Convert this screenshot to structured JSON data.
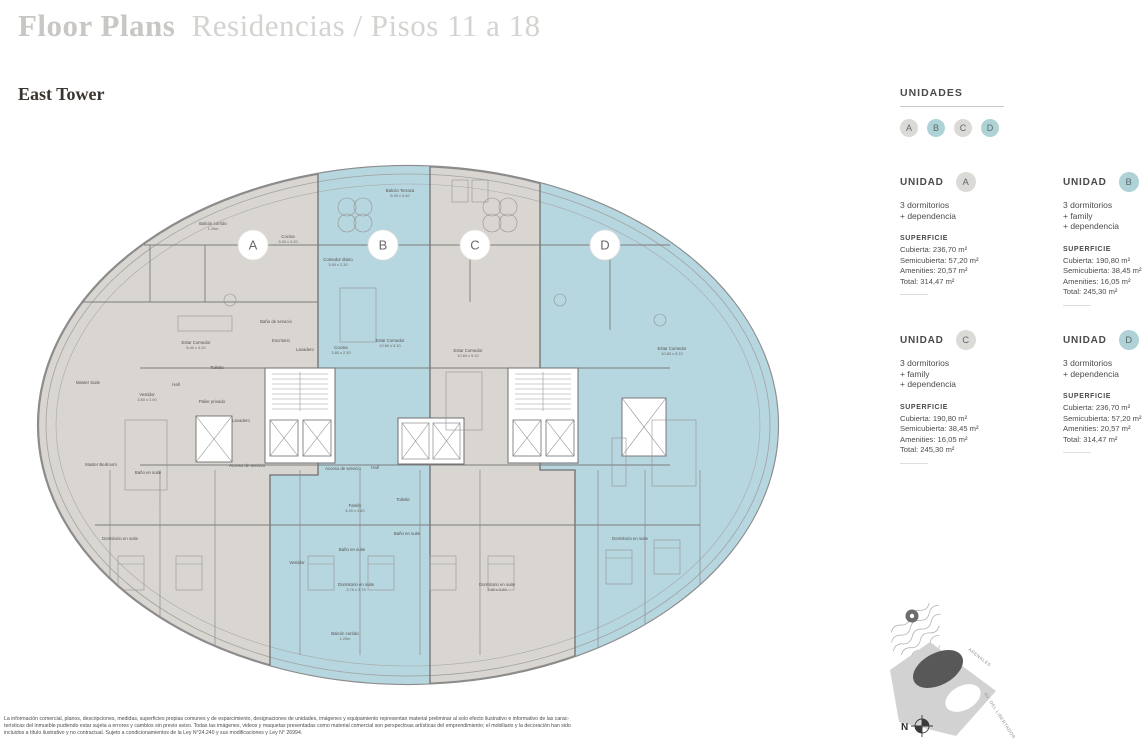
{
  "header": {
    "title_bold": "Floor Plans",
    "title_light": "Residencias / Pisos 11 a 18",
    "subtitle": "East Tower"
  },
  "legend": {
    "title": "UNIDADES",
    "badges": [
      {
        "letter": "A",
        "teal": false
      },
      {
        "letter": "B",
        "teal": true
      },
      {
        "letter": "C",
        "teal": false
      },
      {
        "letter": "D",
        "teal": true
      }
    ]
  },
  "units": [
    {
      "name": "UNIDAD",
      "letter": "A",
      "teal": false,
      "desc": [
        "3 dormitorios",
        "+ dependencia"
      ],
      "sup_title": "SUPERFICIE",
      "sup": [
        "Cubierta: 236,70 m²",
        "Semicubierta: 57,20 m²",
        "Amenities: 20,57 m²",
        "Total: 314,47 m²"
      ]
    },
    {
      "name": "UNIDAD",
      "letter": "B",
      "teal": true,
      "desc": [
        "3 dormitorios",
        "+ family",
        "+ dependencia"
      ],
      "sup_title": "SUPERFICIE",
      "sup": [
        "Cubierta: 190,80 m²",
        "Semicubierta: 38,45 m²",
        "Amenities: 16,05 m²",
        "Total: 245,30 m²"
      ]
    },
    {
      "name": "UNIDAD",
      "letter": "C",
      "teal": false,
      "desc": [
        "3 dormitorios",
        "+ family",
        "+ dependencia"
      ],
      "sup_title": "SUPERFICIE",
      "sup": [
        "Cubierta: 190,80 m²",
        "Semicubierta: 38,45 m²",
        "Amenities: 16,05 m²",
        "Total: 245,30 m²"
      ]
    },
    {
      "name": "UNIDAD",
      "letter": "D",
      "teal": true,
      "desc": [
        "3 dormitorios",
        "+ dependencia"
      ],
      "sup_title": "SUPERFICIE",
      "sup": [
        "Cubierta: 236,70 m²",
        "Semicubierta: 57,20 m²",
        "Amenities: 20,57 m²",
        "Total: 314,47 m²"
      ]
    }
  ],
  "plan": {
    "unit_badges": [
      {
        "letter": "A",
        "x": 253,
        "y": 245
      },
      {
        "letter": "B",
        "x": 383,
        "y": 245
      },
      {
        "letter": "C",
        "x": 475,
        "y": 245
      },
      {
        "letter": "D",
        "x": 605,
        "y": 245
      }
    ],
    "room_labels": [
      {
        "t": "Balcón corrido",
        "d": "1.20m",
        "x": 213,
        "y": 225
      },
      {
        "t": "Cocina",
        "d": "3.00 x 3.20",
        "x": 288,
        "y": 238
      },
      {
        "t": "Balcón Terraza",
        "d": "6.00 x 3.40",
        "x": 400,
        "y": 192
      },
      {
        "t": "Estar Comedor",
        "d": "8.40 x 4.20",
        "x": 196,
        "y": 344
      },
      {
        "t": "Comedor diario",
        "d": "3.90 x 2.30",
        "x": 338,
        "y": 261
      },
      {
        "t": "Master Suite",
        "x": 88,
        "y": 384
      },
      {
        "t": "Vestidor",
        "d": "3.60 x 2.00",
        "x": 147,
        "y": 396
      },
      {
        "t": "Hall",
        "x": 176,
        "y": 386
      },
      {
        "t": "Toilette",
        "x": 217,
        "y": 369
      },
      {
        "t": "Palier privado",
        "x": 212,
        "y": 403
      },
      {
        "t": "Lavadero",
        "x": 241,
        "y": 422
      },
      {
        "t": "Baño de servicio",
        "x": 276,
        "y": 323
      },
      {
        "t": "Escritorio",
        "x": 281,
        "y": 342
      },
      {
        "t": "Lavadero",
        "x": 305,
        "y": 351
      },
      {
        "t": "Cocina",
        "d": "3.60 x 2.30",
        "x": 341,
        "y": 349
      },
      {
        "t": "Estar Comedor",
        "d": "10.60 x 5.10",
        "x": 390,
        "y": 342
      },
      {
        "t": "Estar Comedor",
        "d": "10.60 x 5.10",
        "x": 468,
        "y": 352
      },
      {
        "t": "Estar Comedor",
        "d": "10.60 x 5.10",
        "x": 672,
        "y": 350
      },
      {
        "t": "Acceso de servicio",
        "x": 247,
        "y": 467
      },
      {
        "t": "Acceso de servicio",
        "x": 343,
        "y": 470
      },
      {
        "t": "Hall",
        "x": 375,
        "y": 469
      },
      {
        "t": "Master Bedroom",
        "x": 101,
        "y": 466
      },
      {
        "t": "Baño en suite",
        "x": 148,
        "y": 474
      },
      {
        "t": "Family",
        "d": "4.20 x 3.60",
        "x": 355,
        "y": 507
      },
      {
        "t": "Toilette",
        "x": 403,
        "y": 501
      },
      {
        "t": "Baño en suite",
        "x": 352,
        "y": 551
      },
      {
        "t": "Baño en suite",
        "x": 407,
        "y": 535
      },
      {
        "t": "Vestidor",
        "x": 297,
        "y": 564
      },
      {
        "t": "Dormitorio en suite",
        "d": "3.75 x 3.75",
        "x": 356,
        "y": 586
      },
      {
        "t": "Dormitorio en suite",
        "d": "3.80 x 3.60",
        "x": 497,
        "y": 586
      },
      {
        "t": "Dormitorio en suite",
        "x": 120,
        "y": 540
      },
      {
        "t": "Dormitorio en suite",
        "x": 630,
        "y": 540
      },
      {
        "t": "Balcón corrido",
        "d": "1.20m",
        "x": 345,
        "y": 635
      }
    ]
  },
  "map": {
    "street_1": "ARENALES",
    "street_2": "AV. DEL LIBERTADOR",
    "north": "N"
  },
  "disclaimer": [
    "La información comercial, planos, descripciones, medidas, superficies propias comunes y de esparcimiento, designaciones de unidades, imágenes y equipamiento representan material preliminar al solo efecto ilustrativo e informativo de las carac-",
    "terísticas del inmueble pudiendo estar sujeta a errores y cambios sin previo aviso. Todas las imágenes, videos y maquetas presentadas como material comercial son perspectivas artísticas del emprendimiento; el mobiliario y la decoración han sido",
    "incluidos a título ilustrativo y no contractual. Sujeto a condicionamientos de la Ley N°24.240 y sus modificaciones y Ley N° 26994."
  ],
  "colors": {
    "title_gray": "#c9c7c4",
    "floor_gray": "#d9d6d1",
    "unit_teal": "#b6d6e0",
    "badge_teal": "#aed2d6",
    "badge_gray": "#dbdad7",
    "wall": "#6f6f6f"
  }
}
